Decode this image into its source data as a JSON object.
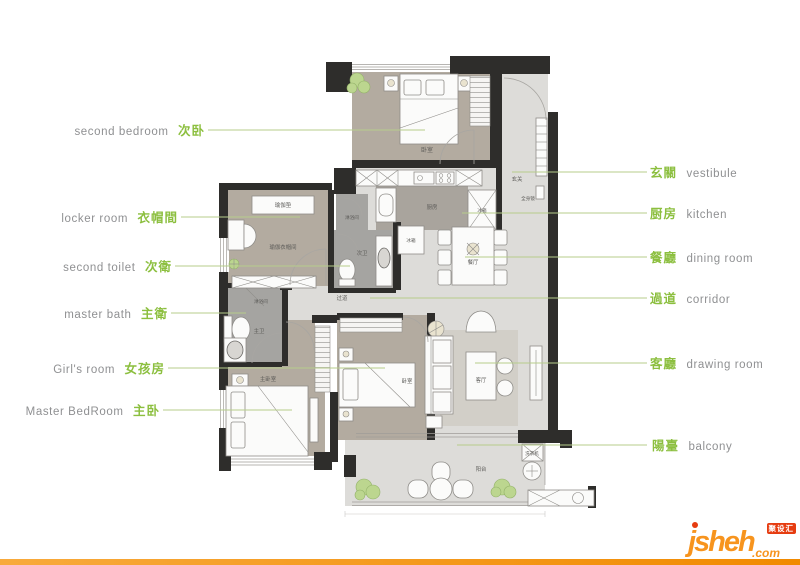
{
  "annotations": {
    "left": [
      {
        "en": "second bedroom",
        "zh": "次卧"
      },
      {
        "en": "locker room",
        "zh": "衣帽間"
      },
      {
        "en": "second toilet",
        "zh": "次衛"
      },
      {
        "en": "master bath",
        "zh": "主衛"
      },
      {
        "en": "Girl's room",
        "zh": "女孩房"
      },
      {
        "en": "Master BedRoom",
        "zh": "主卧"
      }
    ],
    "right": [
      {
        "zh": "玄關",
        "en": "vestibule"
      },
      {
        "zh": "厨房",
        "en": "kitchen"
      },
      {
        "zh": "餐廳",
        "en": "dining room"
      },
      {
        "zh": "過道",
        "en": "corridor"
      },
      {
        "zh": "客廳",
        "en": "drawing room"
      },
      {
        "zh": "陽臺",
        "en": "balcony"
      }
    ]
  },
  "plan_labels": {
    "bedroom2": "卧室",
    "vestibule": "玄关",
    "mirror": "全身镜",
    "kitchen": "厨房",
    "fridge_right": "冰箱",
    "fridge_lower": "冰箱",
    "shower_second": "淋浴间",
    "second_toilet": "次卫",
    "dining": "餐厅",
    "corridor": "过道",
    "shower_master": "淋浴间",
    "master_bath": "主卫",
    "master_bedroom": "主卧室",
    "girls_bedroom": "卧室",
    "living": "客厅",
    "balcony": "阳台",
    "yoga_mat": "瑜伽垫",
    "yoga_locker": "瑜伽衣帽间",
    "washer": "洗衣机"
  },
  "logo": {
    "name": "jsheh",
    "tld": ".com",
    "badge": "聚设汇"
  },
  "colors": {
    "accent_green": "#8cbf3f",
    "label_gray": "#8f9092",
    "leader_line": "#b7cd8b",
    "logo_orange": "#f7941e",
    "badge_red": "#e63c10",
    "wall": "#2e2d2b",
    "floor_warm": "#b3aba0",
    "floor_light": "#dddcd9",
    "floor_dark": "#a5a4a1",
    "bottom_bar_left": "#f8aa3c",
    "bottom_bar_right": "#f18a00"
  }
}
